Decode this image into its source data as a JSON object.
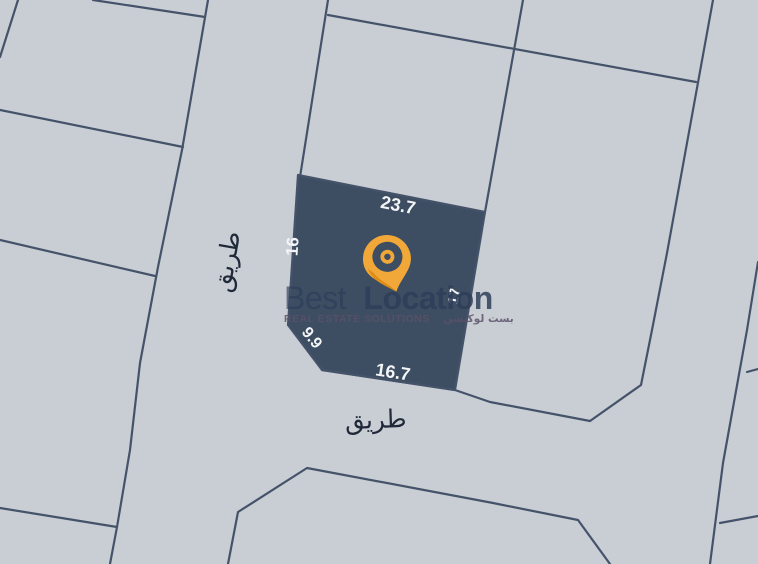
{
  "map": {
    "background": "#c9ced4",
    "line_color": "#45536a",
    "plot": {
      "fill": "#3d4d62",
      "label_color": "#f3f5f7",
      "dim_top": "23.7",
      "dim_left": "16",
      "dim_corner": "9.9",
      "dim_bottom": "16.7",
      "dim_right": "17"
    },
    "road_labels": {
      "left": "طريق",
      "bottom": "طريق",
      "color": "#20293a"
    }
  },
  "watermark": {
    "brand_light": "Best",
    "brand_bold": "Location",
    "subtitle_en": "REAL ESTATE SOLUTIONS",
    "subtitle_ar": "بست لوكيشن",
    "text_color": "#2e3d59",
    "subtitle_color": "#5b5168",
    "pin_main": "#f2a838",
    "pin_shadow": "#dd8d17",
    "pin_ring": "#3d4d62"
  }
}
